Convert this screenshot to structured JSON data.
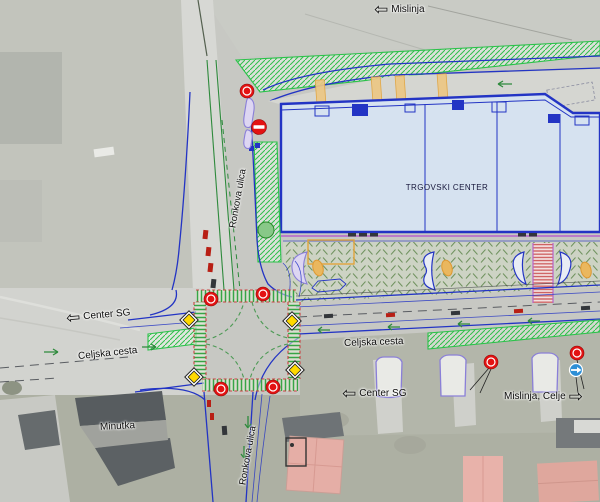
{
  "plan": {
    "building": {
      "label": "TRGOVSKI CENTER"
    },
    "labels": {
      "mislinja_top": {
        "text": "Mislinja",
        "arrow": "⇦"
      },
      "center_sg_left": {
        "text": "Center SG",
        "arrow": "⇦"
      },
      "celjska_cesta_west": {
        "text": "Celjska cesta"
      },
      "celjska_cesta_east": {
        "text": "Celjska cesta"
      },
      "ronkova_ulica_north": {
        "text": "Ronkova ulica"
      },
      "ronkova_ulica_south": {
        "text": "Ronkova ulica"
      },
      "center_sg_bottom": {
        "text": "Center SG",
        "arrow": "⇦"
      },
      "mislinja_celje": {
        "text": "Mislinja, Celje",
        "arrow": "⇨"
      },
      "minutka": {
        "text": "Minutka"
      }
    },
    "signs": [
      "traffic-signal-red",
      "warning-diamond-yellow",
      "no-entry",
      "mandatory-direction-blue"
    ],
    "colors": {
      "plan_blue": "#2334c4",
      "building_fill": "#d6e2f0",
      "green_marking": "#2e8a3c",
      "bright_green": "#2bc24a",
      "signal_red": "#e31212",
      "sign_yellow": "#ffd900",
      "island_purple": "#8a7fd8",
      "magenta": "#b763c9",
      "orange": "#e2a43c",
      "crosswalk_red": "#cc4040",
      "mandatory_blue": "#2d8fd6"
    }
  }
}
